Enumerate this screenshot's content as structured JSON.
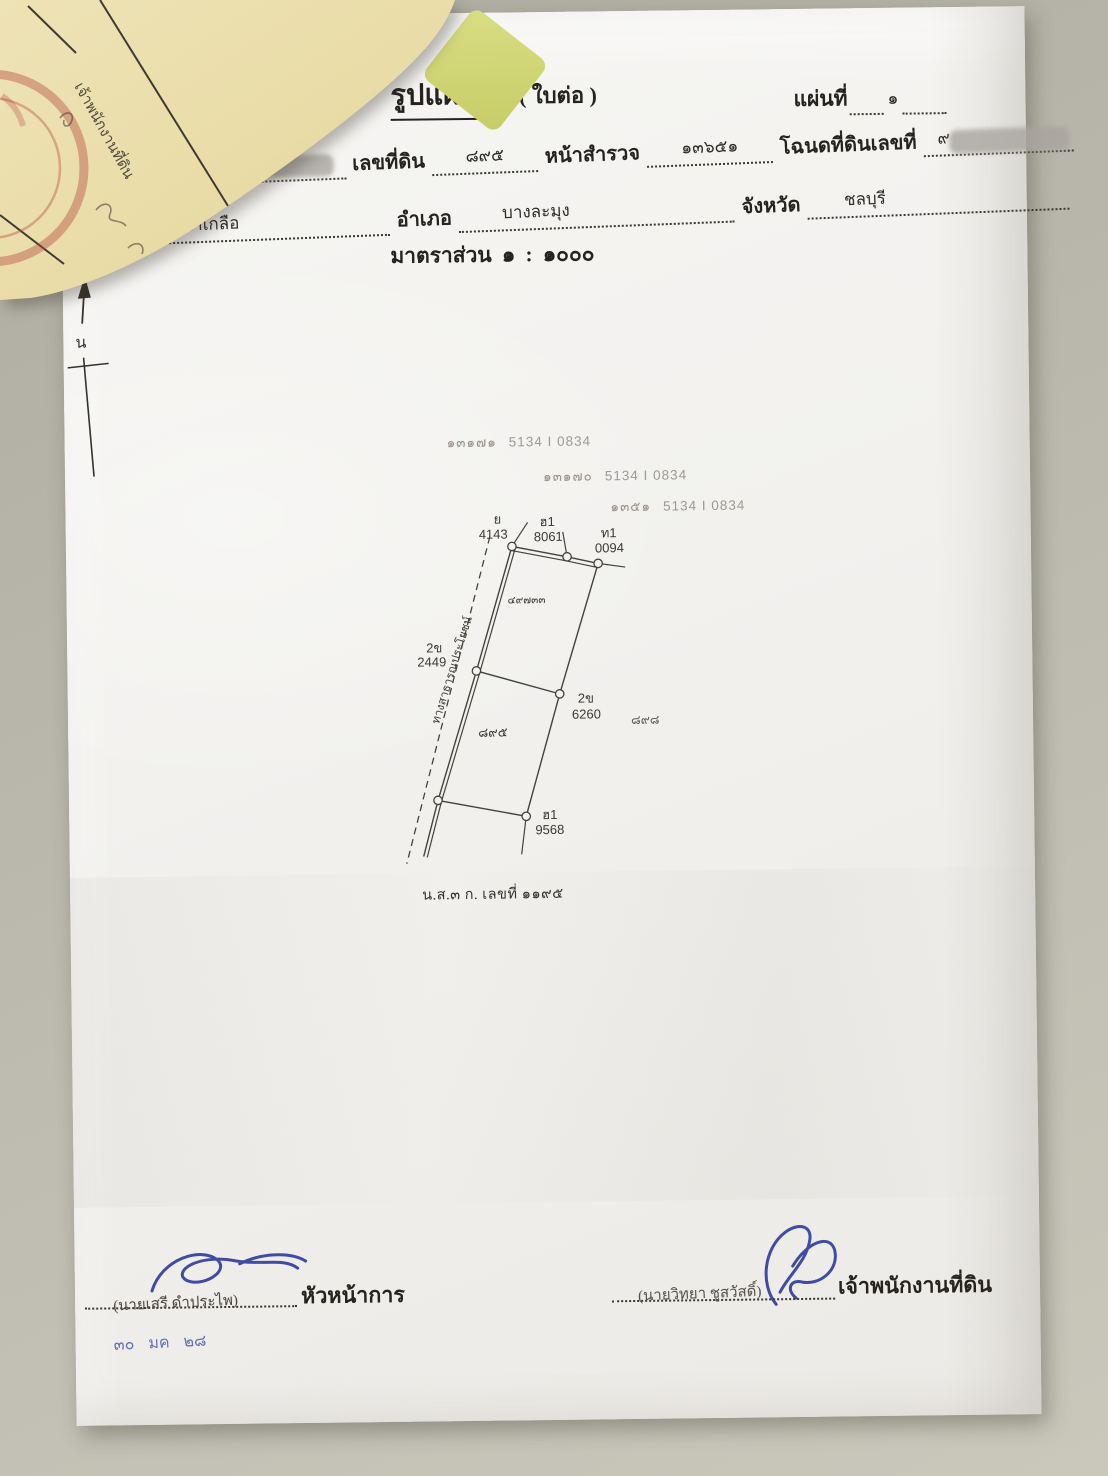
{
  "document": {
    "title": "รูปแผนที่",
    "title_suffix": "( ใบต่อ )",
    "sheet_label": "แผ่นที่",
    "sheet_value": "๑",
    "scale_line": "มาตราส่วน ๑ : ๑๐๐๐",
    "fields": {
      "survey_sheet_label": "ที่ดินระวาง",
      "parcel_label": "เลขที่ดิน",
      "parcel_value": "๘๙๕",
      "survey_page_label": "หน้าสำรวจ",
      "survey_page_value": "๑๓๖๕๑",
      "deed_label": "โฉนดที่ดินเลขที่",
      "deed_value": "๙",
      "subdistrict_label": "ตำบล",
      "subdistrict_value": "นาเกลือ",
      "district_label": "อำเภอ",
      "district_value": "บางละมุง",
      "province_label": "จังหวัด",
      "province_value": "ชลบุรี"
    },
    "caption": "น.ส.๓ ก. เลขที่ ๑๑๙๕"
  },
  "compass": {
    "north_label": "น"
  },
  "survey_stamps": [
    {
      "thai_no": "๑๓๑๗๑",
      "code": "5134 I 0834"
    },
    {
      "thai_no": "๑๓๑๗๐",
      "code": "5134 I 0834"
    },
    {
      "thai_no": "๑๓๕๑",
      "code": "5134 I 0834"
    }
  ],
  "map": {
    "road_label": "ทางสาธารณประโยชน์",
    "upper_parcel_no": "๔๙๗๓๓",
    "lower_parcel_no": "๘๙๕",
    "adjacent_parcel_no": "๘๙๘",
    "vertex_labels": [
      {
        "line1": "ย",
        "line2": "4143"
      },
      {
        "line1": "ฮ1",
        "line2": "8061"
      },
      {
        "line1": "ท1",
        "line2": "0094"
      },
      {
        "line1": "2ข",
        "line2": "2449"
      },
      {
        "line1": "2ข",
        "line2": "6260"
      },
      {
        "line1": "ฮ1",
        "line2": "9568"
      }
    ]
  },
  "signatures": {
    "left": {
      "name": "(นายเสรี ดำประไพ)",
      "title": "หัวหน้าการ",
      "date_note": "๓๐ มค ๒๘"
    },
    "right": {
      "name": "(นายวิทยา ชูสวัสดิ์)",
      "title": "เจ้าพนักงานที่ดิน"
    }
  },
  "background_document": {
    "handwriting": "เจ้าพนักงานที่ดิน"
  },
  "colors": {
    "paper": "#f3f2ef",
    "table_surface": "#bcbaae",
    "old_paper": "#e9dca7",
    "ink": "#2f2c28",
    "blue_ink": "#2f3f9e",
    "red_stamp": "#b5443a",
    "faded_stamp": "#8d7f76"
  }
}
